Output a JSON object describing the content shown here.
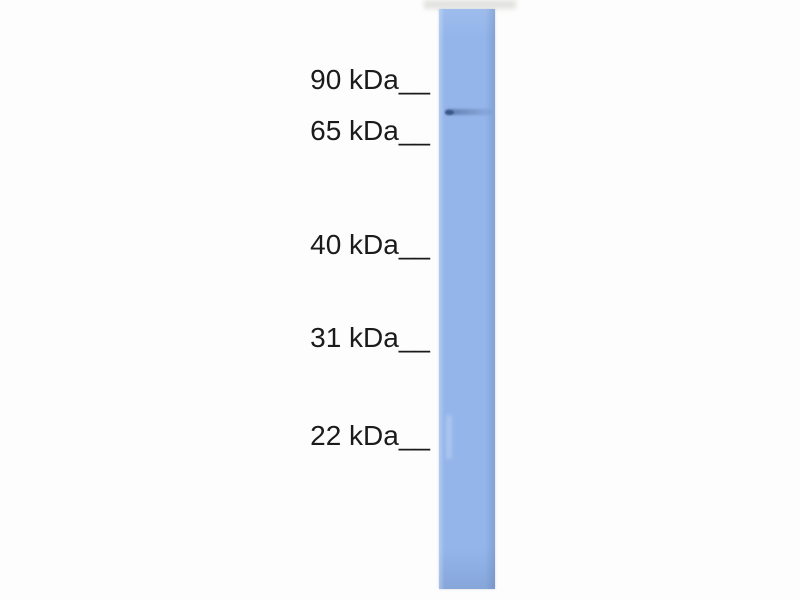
{
  "blot": {
    "background_color": "#fdfdfd",
    "text_color": "#1b1b1b",
    "lane_color": "#93b5ea",
    "markers": [
      {
        "label": "90 kDa__",
        "kda": 90
      },
      {
        "label": "65 kDa__",
        "kda": 65
      },
      {
        "label": "40 kDa__",
        "kda": 40
      },
      {
        "label": "31 kDa__",
        "kda": 31
      },
      {
        "label": "22 kDa__",
        "kda": 22
      }
    ],
    "band": {
      "color": "#3e5887",
      "located_between_markers": [
        "90 kDa",
        "65 kDa"
      ]
    }
  }
}
